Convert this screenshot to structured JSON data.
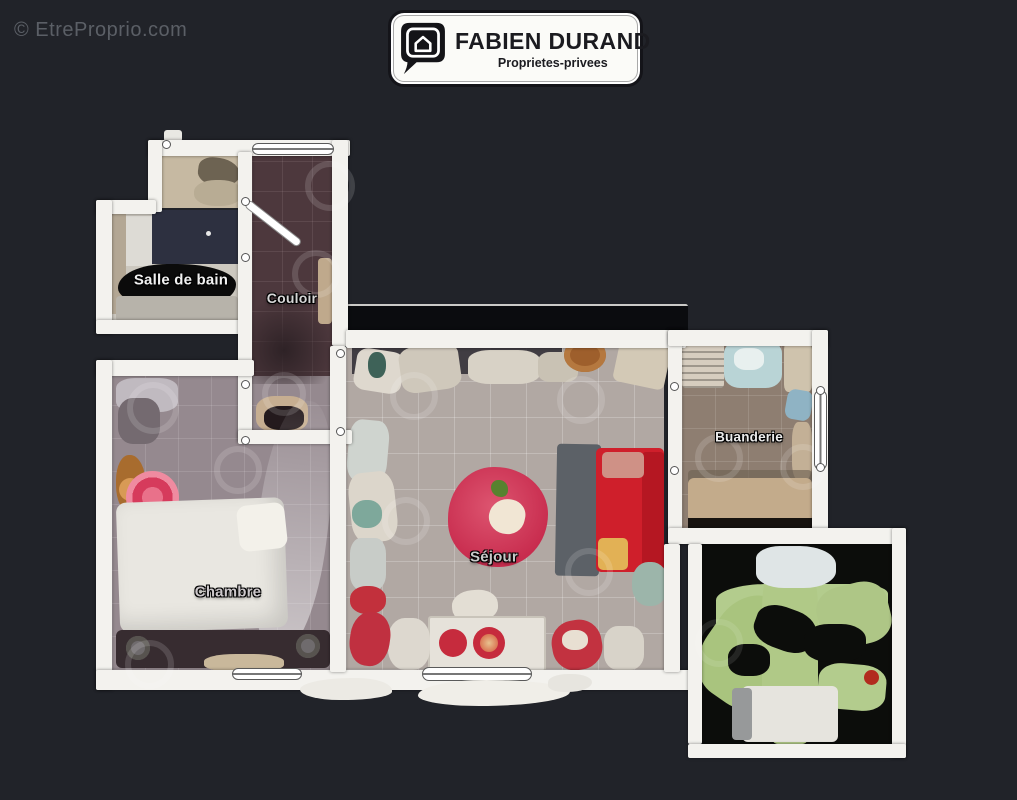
{
  "watermark": {
    "text": "© EtreProprio.com"
  },
  "logo": {
    "title": "FABIEN DURAND",
    "subtitle": "Proprietes-privees",
    "icon": "house-in-speech-bubble"
  },
  "floorplan": {
    "type": "real-estate-top-down-scan",
    "rooms": [
      {
        "id": "salle-de-bain",
        "label": "Salle de bain"
      },
      {
        "id": "couloir",
        "label": "Couloir"
      },
      {
        "id": "chambre",
        "label": "Chambre"
      },
      {
        "id": "sejour",
        "label": "Séjour"
      },
      {
        "id": "buanderie",
        "label": "Buanderie"
      },
      {
        "id": "piece-exterieure-verte",
        "label": ""
      }
    ],
    "colors": {
      "background": "#212329",
      "wall": "#f3f2ee",
      "couloir_floor": "#4d383d",
      "chambre_floor": "#95898f",
      "sejour_floor": "#b1a8a3",
      "buanderie_floor": "#8e7e71",
      "bathroom_tub": "#2d3040",
      "green_floor": "#b3cc8d",
      "accent_red": "#cf1f2b",
      "table_red": "#c82c4e",
      "unscanned_black": "#0c0d0b"
    }
  }
}
